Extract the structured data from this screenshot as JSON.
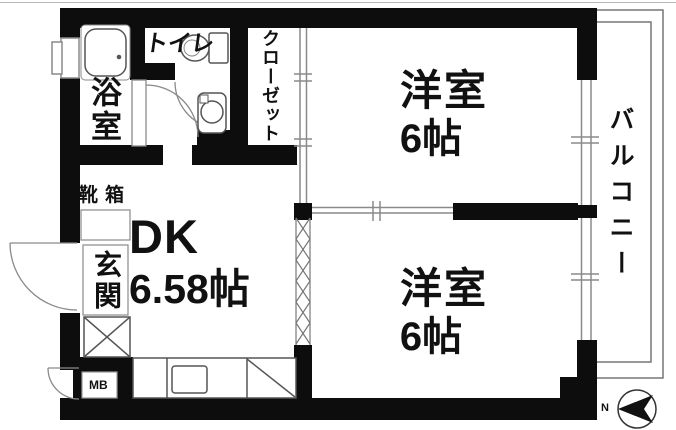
{
  "rooms": {
    "bath": {
      "label": "浴室"
    },
    "toilet": {
      "label": "トイレ"
    },
    "closet": {
      "label": "クローゼット"
    },
    "western_room_top": {
      "label": "洋室",
      "size": "6帖"
    },
    "western_room_bottom": {
      "label": "洋室",
      "size": "6帖"
    },
    "dining_kitchen": {
      "label": "DK",
      "size": "6.58帖"
    },
    "entrance": {
      "label": "玄関"
    },
    "shoe_box": {
      "label": "靴箱"
    },
    "balcony": {
      "label": "バルコニー"
    },
    "meter_box": {
      "label": "MB"
    }
  },
  "compass": {
    "north_label": "N"
  },
  "colors": {
    "wall": "#0d0d0d",
    "thin_line": "#8a8a8a",
    "fixture_line": "#555555",
    "balcony_line": "#777777",
    "background": "#ffffff"
  }
}
